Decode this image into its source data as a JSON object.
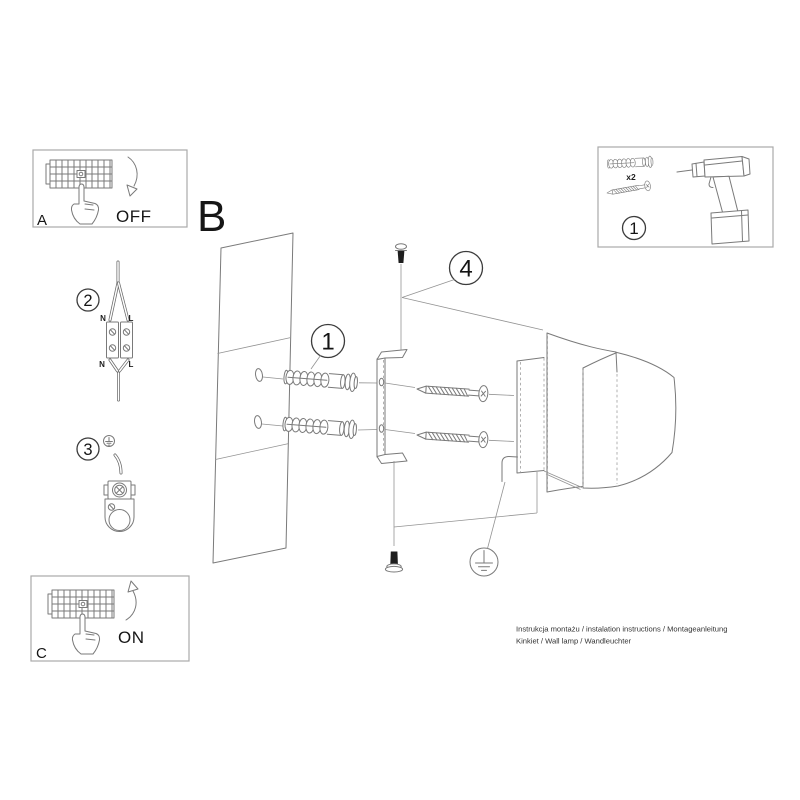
{
  "footer": {
    "line1": "Instrukcja montażu / instalation instructions / Montageanleitung",
    "line2": "Kinkiet / Wall lamp / Wandleuchter"
  },
  "labels": {
    "section_b": "B",
    "panel_a": "A",
    "panel_a_state": "OFF",
    "panel_c": "C",
    "panel_c_state": "ON"
  },
  "badges": {
    "step1": "1",
    "step2": "2",
    "step3": "3",
    "step4": "4",
    "tools": "1"
  },
  "tools_box": {
    "quantity": "x2"
  },
  "wiring": {
    "in_n": "N",
    "in_l": "L",
    "out_n": "N",
    "out_l": "L"
  },
  "colors": {
    "line": "#7a7a7a",
    "text": "#1c1c1c",
    "bolt": "#1e1e1e",
    "background": "#ffffff"
  }
}
